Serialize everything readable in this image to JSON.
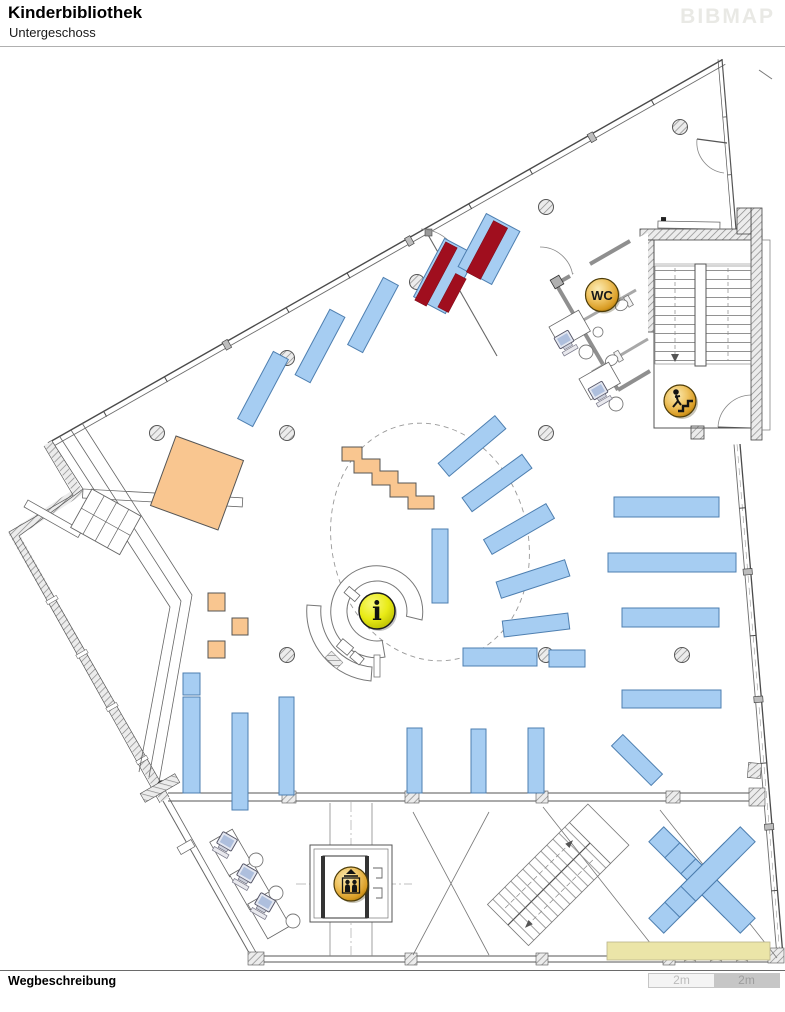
{
  "header": {
    "title": "Kinderbibliothek",
    "subtitle": "Untergeschoss",
    "logo": "BIBMAP"
  },
  "footer": {
    "label": "Wegbeschreibung"
  },
  "scale_bar": {
    "segments": [
      {
        "label": "2m"
      },
      {
        "label": "2m"
      }
    ]
  },
  "map": {
    "floor_label": "Untergeschoss",
    "icons": {
      "wc": {
        "label": "WC"
      },
      "info": {
        "label": "i"
      },
      "stairs": {
        "label": ""
      },
      "elevator": {
        "label": ""
      }
    },
    "colors": {
      "shelf_fill": "#A6CDF2",
      "shelf_border": "#4E7FB0",
      "highlight_fill": "#A00E1E",
      "furniture_fill": "#F9C690",
      "mat_fill": "#EBE5A8",
      "icon_gold": "#E2AC3C",
      "icon_yellow": "#E9EB16",
      "wall": "#555555"
    }
  }
}
